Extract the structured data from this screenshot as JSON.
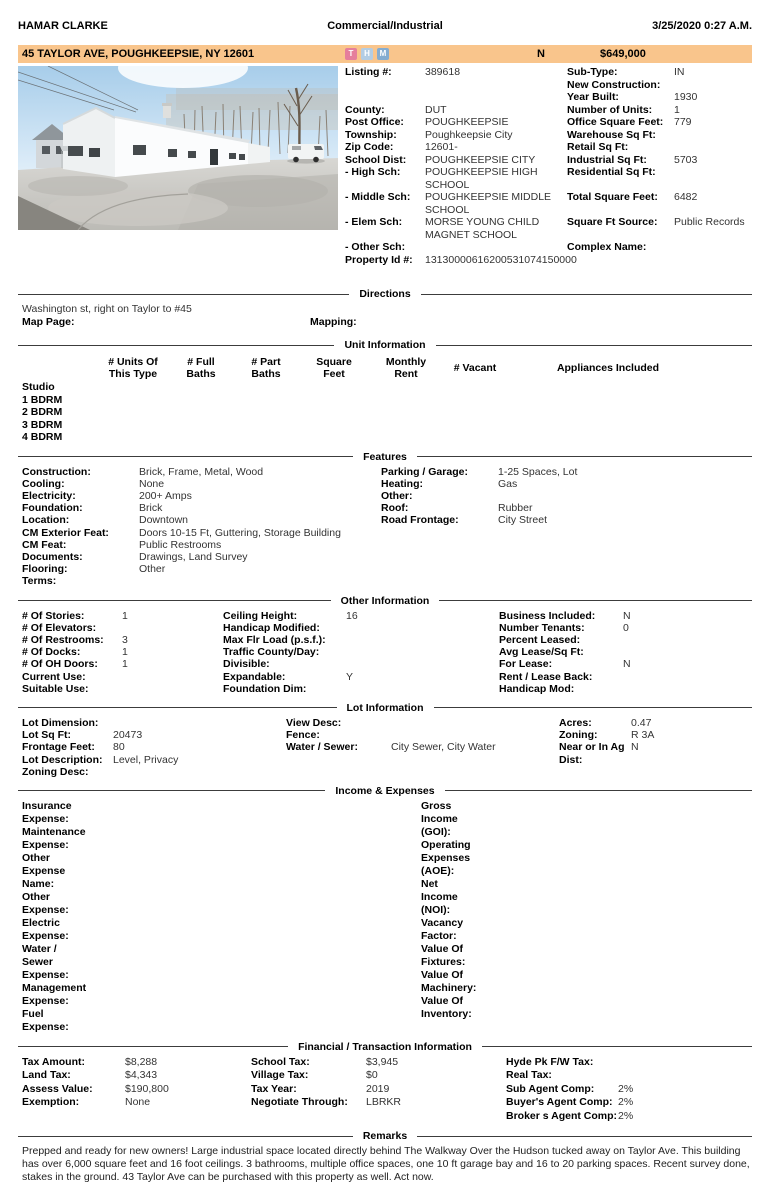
{
  "header": {
    "agent_name": "HAMAR CLARKE",
    "report_type": "Commercial/Industrial",
    "datetime": "3/25/2020  0:27 A.M."
  },
  "colors": {
    "listing_bar_bg": "#f9c58c",
    "tax_icon": "#e57f9c",
    "history_icon": "#b3cde4",
    "map_icon": "#84acd0"
  },
  "listing_bar": {
    "address": "45 TAYLOR AVE, POUGHKEEPSIE, NY 12601",
    "icons": [
      {
        "name": "t-icon",
        "letter": "T"
      },
      {
        "name": "h-icon",
        "letter": "H"
      },
      {
        "name": "m-icon",
        "letter": "M"
      }
    ],
    "flag": "N",
    "price": "$649,000"
  },
  "summary": {
    "rows": [
      {
        "l1": "Listing #:",
        "v1": "389618",
        "l2": "Sub-Type:",
        "v2": "IN"
      },
      {
        "l1": "",
        "v1": "",
        "l2": "New Construction:",
        "v2": ""
      },
      {
        "l1": "",
        "v1": "",
        "l2": "Year Built:",
        "v2": "1930"
      },
      {
        "l1": "County:",
        "v1": "DUT",
        "l2": "Number of Units:",
        "v2": "1"
      },
      {
        "l1": "Post Office:",
        "v1": "POUGHKEEPSIE",
        "l2": "Office Square Feet:",
        "v2": "779"
      },
      {
        "l1": "Township:",
        "v1": "Poughkeepsie City",
        "l2": "Warehouse Sq Ft:",
        "v2": ""
      },
      {
        "l1": "Zip Code:",
        "v1": "12601-",
        "l2": "Retail Sq Ft:",
        "v2": ""
      },
      {
        "l1": "School Dist:",
        "v1": "POUGHKEEPSIE CITY",
        "l2": "Industrial Sq Ft:",
        "v2": "5703"
      },
      {
        "l1": "- High Sch:",
        "v1": "POUGHKEEPSIE HIGH\nSCHOOL",
        "l2": "Residential Sq Ft:",
        "v2": ""
      },
      {
        "l1": "- Middle Sch:",
        "v1": "POUGHKEEPSIE MIDDLE\nSCHOOL",
        "l2": "Total Square Feet:",
        "v2": "6482"
      },
      {
        "l1": "- Elem Sch:",
        "v1": "MORSE YOUNG CHILD\nMAGNET SCHOOL",
        "l2": "Square Ft Source:",
        "v2": "Public Records"
      },
      {
        "l1": "- Other Sch:",
        "v1": "",
        "l2": "Complex Name:",
        "v2": ""
      }
    ],
    "property_id_label": "Property Id #:",
    "property_id_value": "13130000616200531074150000"
  },
  "directions": {
    "title": "Directions",
    "text": "Washington st, right on Taylor to #45",
    "map_page_label": "Map Page:",
    "mapping_label": "Mapping:"
  },
  "unit_information": {
    "title": "Unit Information",
    "headers": [
      "# Units Of\nThis Type",
      "# Full\nBaths",
      "# Part\nBaths",
      "Square\nFeet",
      "Monthly\nRent",
      "# Vacant",
      "Appliances Included"
    ],
    "rows": [
      "Studio",
      "1 BDRM",
      "2 BDRM",
      "3 BDRM",
      "4 BDRM"
    ]
  },
  "features": {
    "title": "Features",
    "left": [
      {
        "label": "Construction:",
        "value": "Brick, Frame, Metal, Wood"
      },
      {
        "label": "Cooling:",
        "value": "None"
      },
      {
        "label": "Electricity:",
        "value": "200+ Amps"
      },
      {
        "label": "Foundation:",
        "value": "Brick"
      },
      {
        "label": "Location:",
        "value": "Downtown"
      },
      {
        "label": "CM Exterior Feat:",
        "value": "Doors 10-15 Ft, Guttering, Storage Building"
      },
      {
        "label": "CM Feat:",
        "value": "Public Restrooms"
      },
      {
        "label": "Documents:",
        "value": "Drawings, Land Survey"
      },
      {
        "label": "Flooring:",
        "value": "Other"
      },
      {
        "label": "Terms:",
        "value": ""
      }
    ],
    "right": [
      {
        "label": "Parking / Garage:",
        "value": "1-25 Spaces, Lot"
      },
      {
        "label": "Heating:",
        "value": "Gas"
      },
      {
        "label": "Other:",
        "value": ""
      },
      {
        "label": "Roof:",
        "value": "Rubber"
      },
      {
        "label": "Road Frontage:",
        "value": "City Street"
      }
    ]
  },
  "other_information": {
    "title": "Other Information",
    "col1": [
      {
        "label": "# Of Stories:",
        "value": "1"
      },
      {
        "label": "# Of Elevators:",
        "value": ""
      },
      {
        "label": "# Of Restrooms:",
        "value": "3"
      },
      {
        "label": "# Of Docks:",
        "value": "1"
      },
      {
        "label": "# Of OH Doors:",
        "value": "1"
      },
      {
        "label": "Current Use:",
        "value": ""
      },
      {
        "label": "Suitable Use:",
        "value": ""
      }
    ],
    "col2": [
      {
        "label": "Ceiling Height:",
        "value": "16"
      },
      {
        "label": "Handicap Modified:",
        "value": ""
      },
      {
        "label": "Max Flr Load (p.s.f.):",
        "value": ""
      },
      {
        "label": "Traffic County/Day:",
        "value": ""
      },
      {
        "label": "Divisible:",
        "value": ""
      },
      {
        "label": "Expandable:",
        "value": "Y"
      },
      {
        "label": "Foundation Dim:",
        "value": ""
      }
    ],
    "col3": [
      {
        "label": "Business Included:",
        "value": "N"
      },
      {
        "label": "Number Tenants:",
        "value": "0"
      },
      {
        "label": "Percent Leased:",
        "value": ""
      },
      {
        "label": "Avg Lease/Sq Ft:",
        "value": ""
      },
      {
        "label": "For Lease:",
        "value": "N"
      },
      {
        "label": "Rent / Lease Back:",
        "value": ""
      },
      {
        "label": "Handicap Mod:",
        "value": ""
      }
    ]
  },
  "lot_information": {
    "title": "Lot Information",
    "col1": [
      {
        "label": "Lot Dimension:",
        "value": ""
      },
      {
        "label": "Lot Sq Ft:",
        "value": "20473"
      },
      {
        "label": "Frontage Feet:",
        "value": "80"
      },
      {
        "label": "Lot Description:",
        "value": "Level, Privacy"
      },
      {
        "label": "Zoning Desc:",
        "value": ""
      }
    ],
    "col2": [
      {
        "label": "View Desc:",
        "value": ""
      },
      {
        "label": "Fence:",
        "value": ""
      },
      {
        "label": "Water / Sewer:",
        "value": "City Sewer, City Water"
      }
    ],
    "col3": [
      {
        "label": "Acres:",
        "value": "0.47"
      },
      {
        "label": "Zoning:",
        "value": "R 3A"
      },
      {
        "label": "Near or In Ag Dist:",
        "value": "N"
      }
    ]
  },
  "income_expenses": {
    "title": "Income & Expenses",
    "left": [
      {
        "label": "Insurance Expense:",
        "value": ""
      },
      {
        "label": "Maintenance Expense:",
        "value": ""
      },
      {
        "label": "Other Expense Name:",
        "value": ""
      },
      {
        "label": "Other Expense:",
        "value": ""
      },
      {
        "label": "Electric Expense:",
        "value": ""
      },
      {
        "label": "Water / Sewer Expense:",
        "value": ""
      },
      {
        "label": "Management Expense:",
        "value": ""
      },
      {
        "label": "Fuel Expense:",
        "value": ""
      }
    ],
    "right": [
      {
        "label": "Gross Income (GOI):",
        "value": ""
      },
      {
        "label": "Operating Expenses (AOE):",
        "value": ""
      },
      {
        "label": "Net Income (NOI):",
        "value": ""
      },
      {
        "label": "Vacancy Factor:",
        "value": ""
      },
      {
        "label": "Value Of Fixtures:",
        "value": ""
      },
      {
        "label": "Value Of Machinery:",
        "value": ""
      },
      {
        "label": "Value Of Inventory:",
        "value": ""
      }
    ]
  },
  "financial": {
    "title": "Financial / Transaction Information",
    "col1": [
      {
        "label": "Tax Amount:",
        "value": "$8,288"
      },
      {
        "label": "Land Tax:",
        "value": "$4,343"
      },
      {
        "label": "Assess Value:",
        "value": "$190,800"
      },
      {
        "label": "Exemption:",
        "value": "None"
      }
    ],
    "col2": [
      {
        "label": "School Tax:",
        "value": "$3,945"
      },
      {
        "label": "Village Tax:",
        "value": "$0"
      },
      {
        "label": "Tax Year:",
        "value": "2019"
      },
      {
        "label": "Negotiate Through:",
        "value": "LBRKR"
      }
    ],
    "col3": [
      {
        "label": "Hyde Pk F/W Tax:",
        "value": ""
      },
      {
        "label": "Real Tax:",
        "value": ""
      },
      {
        "label": "Sub Agent Comp:",
        "value": "2%"
      },
      {
        "label": "Buyer's Agent Comp:",
        "value": "2%"
      },
      {
        "label": "Broker s Agent Comp:",
        "value": "2%"
      }
    ]
  },
  "remarks": {
    "title": "Remarks",
    "text": "Prepped and ready for new owners! Large industrial space located directly behind The Walkway Over the Hudson tucked away on Taylor Ave. This building has over 6,000 square feet and 16 foot ceilings. 3 bathrooms, multiple office spaces, one 10 ft garage bay and 16 to 20 parking spaces. Recent survey done, stakes in the ground. 43 Taylor Ave can be purchased with this property as well. Act now."
  }
}
